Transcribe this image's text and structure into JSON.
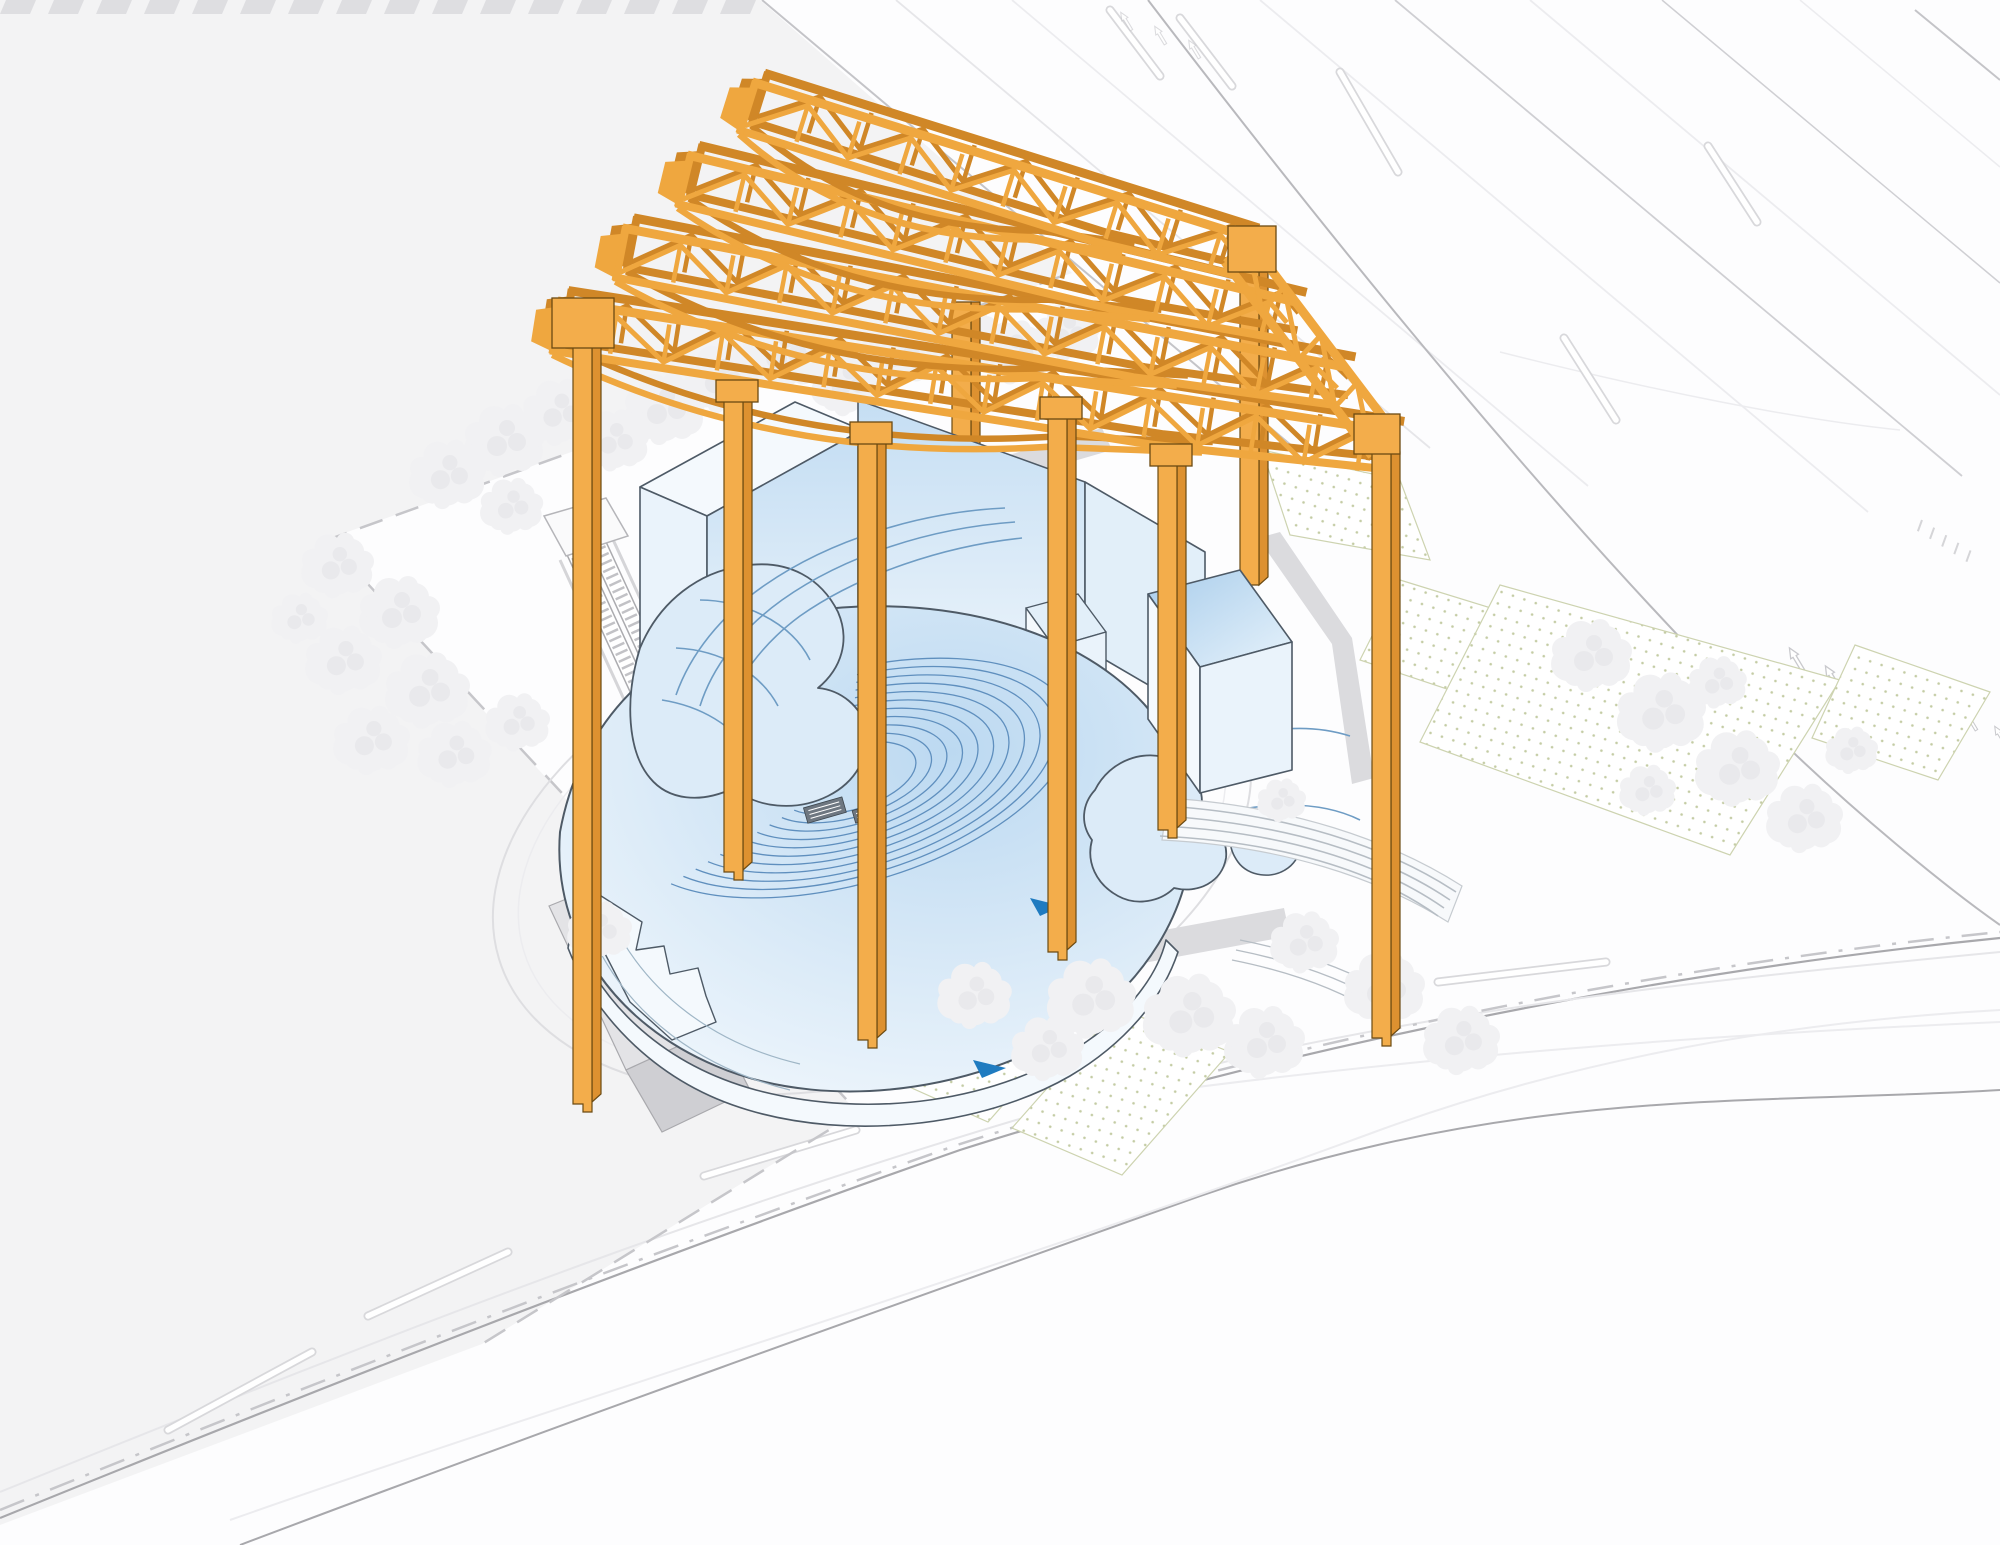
{
  "diagram": {
    "title": "Axonometric site diagram — orange gantry crane frame over a blue cutaway amphitheater building",
    "type": "architectural-axonometric-site-diagram",
    "scene": {
      "gantry_crane": {
        "name": "heritage gantry crane frame",
        "columns": 8,
        "roof_trusses": 4,
        "edge_truss": 1,
        "color_ref": "craneMain"
      },
      "theater_building": {
        "name": "amphitheater building shown in cutaway",
        "color_ref": "wallLight",
        "features": [
          "curved seating rows",
          "organic balcony structures",
          "stage equipment",
          "rectangular service volumes",
          "cube annex"
        ]
      },
      "site": {
        "features": [
          "dashed property boundary",
          "circular plaza outline",
          "double escalator ramp",
          "sunken entry walls",
          "dotted planting beds",
          "street trees",
          "curved terrace steps",
          "perimeter roads with lane dashes",
          "crosswalk marks",
          "lane arrows",
          "road tick markings"
        ]
      }
    }
  },
  "palette": {
    "bg": "#FDFDFE",
    "block": "#F3F3F4",
    "blockBar": "#DEDEE1",
    "roadDark": "#A8A8AC",
    "roadFaint": "#E6E6E9",
    "roadFainter": "#ECECEF",
    "dashBound": "#C6C6CA",
    "pathGray": "#DBDBDE",
    "wedgeLight": "#E3E3E6",
    "wedgeDark": "#CFCFD3",
    "treeFill": "#F1F1F3",
    "treeShade": "#E9E9EC",
    "dotFill": "#C4CCA4",
    "bedLine": "#CDD3B0",
    "craneMain": "#EFA73F",
    "craneDark": "#D08727",
    "craneFace": "#F3AD4B",
    "craneSide": "#DD9130",
    "craneLine": "#6B4A12",
    "ink": "#4E5A66",
    "wallPale": "#F4F9FD",
    "wallLight": "#EAF3FB",
    "wallMid": "#E2EFF9",
    "gradTop1": "#C5DEF3",
    "gradTop2": "#EFF6FC",
    "cube1": "#A9CDEB",
    "cube2": "#E6F2FB",
    "bowl1": "#BCD9F1",
    "bowl2": "#EFF6FC",
    "seat": "#5F8FBE",
    "blob": "#DCEBF8",
    "swoosh": "#6E9CC4",
    "accentBlue": "#1F7BC0",
    "equip": "#6E7781",
    "terrLine": "#B6BDC4",
    "terrFill": "#F7F9FB",
    "terrEdge": "#C6CBD0",
    "white": "#FFFFFF",
    "escRail": "#ABABAF",
    "escRung": "#C2C2C6",
    "landing": "#FAFAFB",
    "landingEdge": "#B5B5B9",
    "wedgeEdge": "#A9A9AD"
  }
}
